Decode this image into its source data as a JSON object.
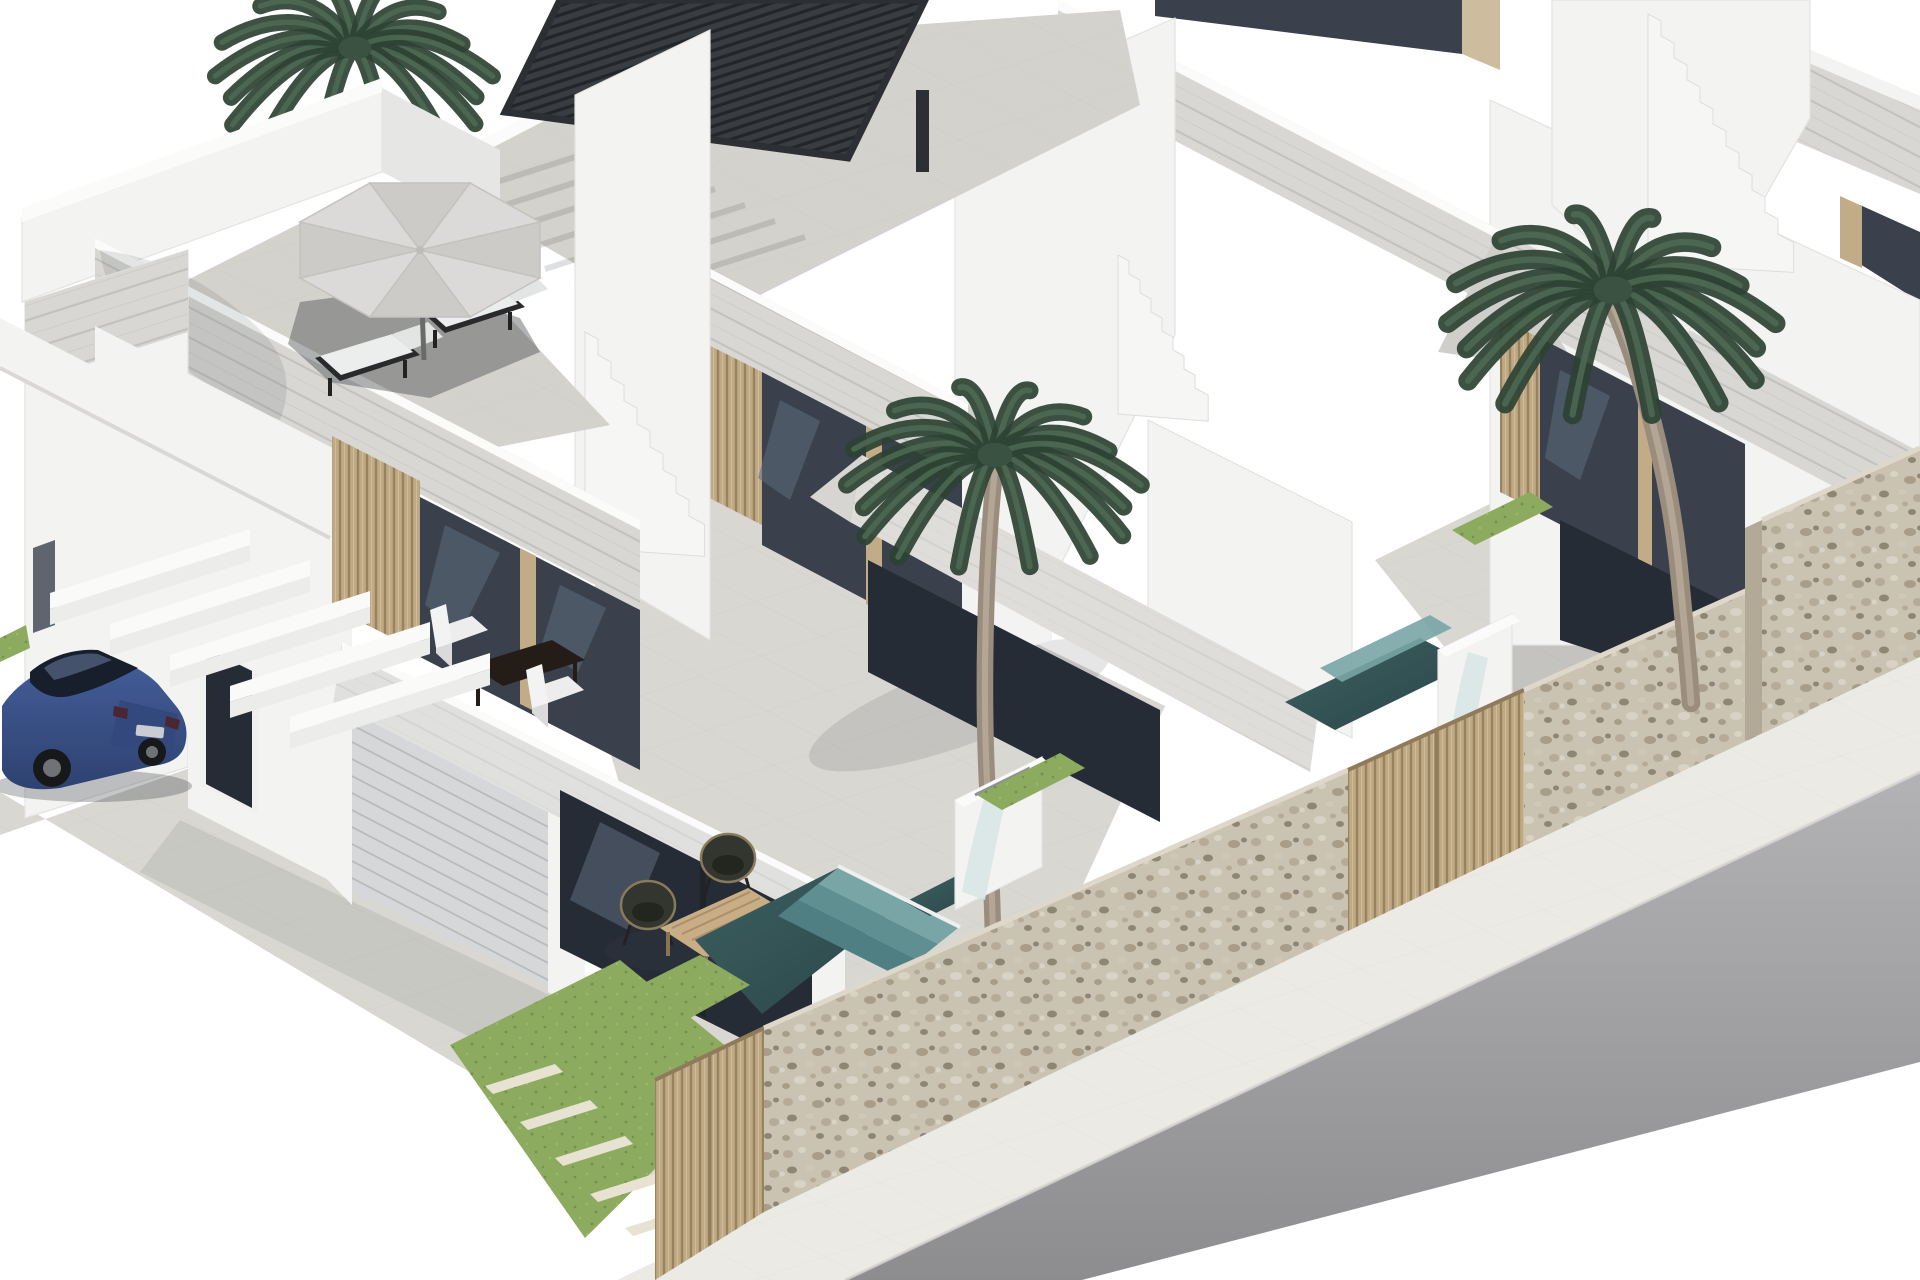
{
  "scene": {
    "type": "architectural-3d-render",
    "description": "Isometric 3D real-estate rendering of a row of modern white two-storey townhouses with rooftop terraces. The front house has a gray parasol with two sun loungers on the roof, a balcony with white chairs and a dark table, a garage, a covered patio with wicker chairs and a wooden coffee table, and a blue sedan parked under white carport beams. The neighbouring houses have a black louvered pergola on the roof terrace, white staircases, tall palm trees, plunge pools with teal mosaic steps and white waterfall walls, rubble-stone boundary walls, wooden slat gates, lawn strips with stepping stones, a white sidewalk and a gray asphalt street.",
    "time_of_day": "bright daylight, white sky background",
    "buildings": [
      {
        "name": "house-1-front",
        "features": [
          "roof terrace with gray octagonal parasol",
          "two black sun loungers with white pads",
          "stone-clad fascia bands",
          "first-floor balcony with two white chairs and dark brown table",
          "wood-slat wall with dark sliding glass doors",
          "sectional garage door",
          "dark entrance door",
          "small window with tan frame on side wall",
          "ground-floor patio with two dark wicker chairs and slatted wood coffee table",
          "white carport pergola beams over parking space"
        ]
      },
      {
        "name": "house-2-middle",
        "features": [
          "black louvered bioclimatic pergola on roof terrace",
          "stone-clad parapet bands",
          "chamfered balcony fascia",
          "dark sliding glass doors with tan mullions",
          "white side staircase with steps",
          "plunge pool with teal mosaic steps",
          "white waterfall water feature"
        ]
      },
      {
        "name": "house-3-right",
        "features": [
          "stone-clad roof band",
          "white staircase",
          "balcony with dark glass doors",
          "terrace with tall palm tree",
          "plunge pool with teal mosaic steps",
          "white waterfall wall",
          "corner rubble-stone pool wall"
        ]
      },
      {
        "name": "house-4-corner-sliver",
        "features": [
          "partially visible roof slab at top right corner"
        ]
      }
    ],
    "vegetation": {
      "palm_trees": 3,
      "positions": [
        "top-left behind front house roof",
        "center courtyard of middle house",
        "right courtyard of right house"
      ],
      "lawn": "green strips with white rectangular stepping stones"
    },
    "vehicle": {
      "type": "sedan",
      "color_name": "blue",
      "position": "parked under white carport beams at left"
    },
    "street": {
      "road": "gray asphalt running diagonally across bottom right",
      "sidewalk": "white paved band between boundary walls and road"
    },
    "water_features": [
      "plunge pool with three teal mosaic steps in front of middle house",
      "plunge pool with teal steps at right edge",
      "two white waterfall blocks with falling water sheets"
    ],
    "boundary": [
      "rubble stone walls",
      "vertical wood-slat gates"
    ],
    "palette": {
      "background": "#ffffff",
      "wall-white": "#f3f3f2",
      "wall-shade": "#e6e6e5",
      "wall-outline": "#e3e3e2",
      "stone-band": "#d8d7d4",
      "stone-joint": "#c2c1be",
      "tile-floor": "#d8d7d2",
      "tile-line": "#c6c5c1",
      "deck-tile": "#d4d2cc",
      "glass-dark": "#3a414d",
      "glass-deep": "#262c36",
      "glass-reflection": "#5d6b7d",
      "frame-tan": "#c2ab87",
      "wood-slat": "#c0a985",
      "wood-dark": "#98835f",
      "garage-door": "#d6d7d9",
      "garage-line": "#b9babd",
      "grass": "#8cab5f",
      "grass-dark": "#74904c",
      "stepping-stone": "#e7e2d2",
      "pool-deep": "#2b4649",
      "pool-steps": "#79a5a6",
      "pool-steps-dark": "#608f91",
      "water-sheet": "#d9e6e7",
      "stone-wall": "#cbc3b2",
      "stone-wall-dark": "#b2a996",
      "road-light": "#b3b3b5",
      "road-dark": "#8d8d8f",
      "sidewalk": "#eceae5",
      "pergola-black": "#393c40",
      "pergola-line": "#222529",
      "palm-dark": "#2c4233",
      "palm-light": "#4f6c55",
      "palm-trunk": "#9b8d7d",
      "car-blue": "#445d99",
      "car-blue-dark": "#2e4270",
      "car-glass": "#171e2c",
      "umbrella-gray": "#dbdad8",
      "umbrella-gray-dark": "#cccbc8",
      "shadow": "#3c4146"
    }
  }
}
